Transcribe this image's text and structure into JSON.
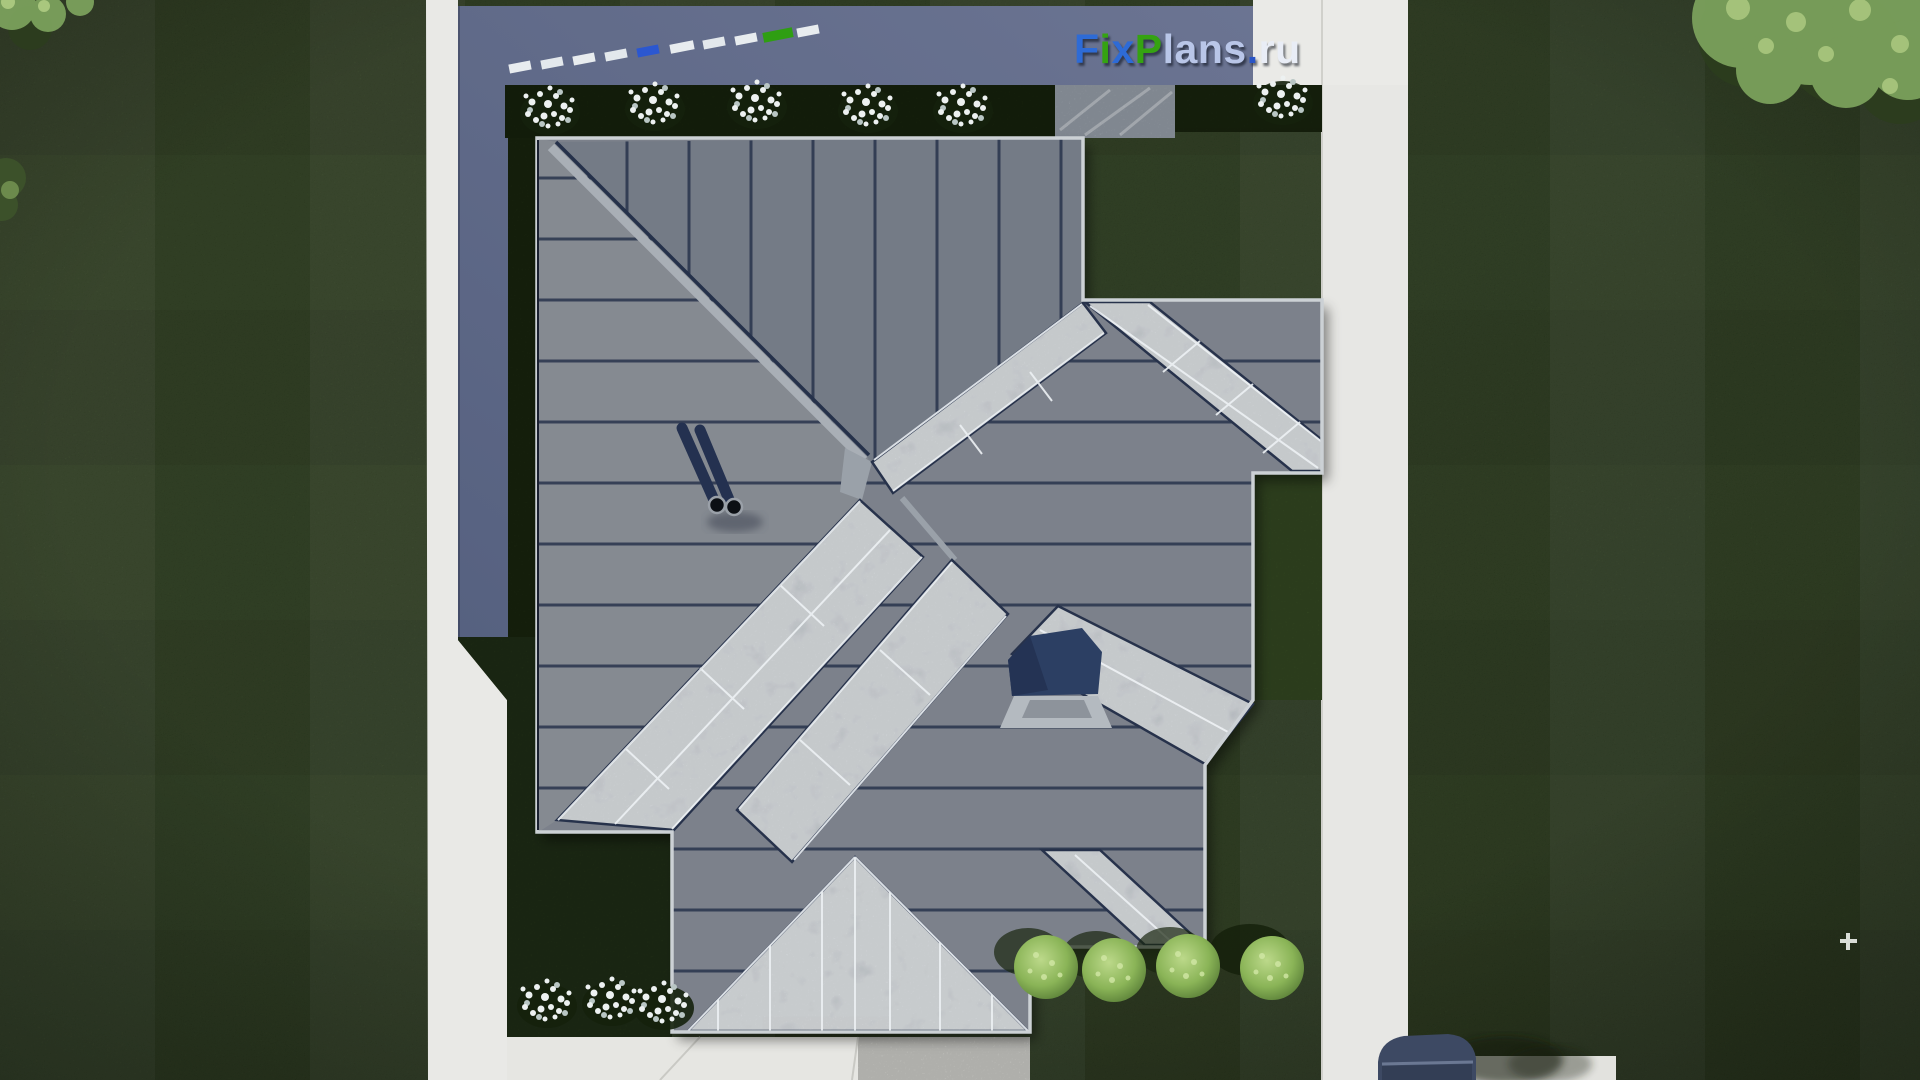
{
  "image": {
    "type": "aerial-top-down-3d-render",
    "subject": "single-family house with gray standing-seam hip roof and long glass skylight bands, surrounded by lawn, concrete paths, paved terrace and landscaping",
    "view": "directly overhead (roof plan render)"
  },
  "watermark": {
    "text": "FixPlans.ru",
    "letters": [
      "F",
      "i",
      "x",
      "P",
      "l",
      "a",
      "n",
      "s",
      ".",
      "r",
      "u"
    ],
    "letter_colors": [
      "blue",
      "green",
      "blue",
      "green",
      "pale-blue",
      "pale-blue",
      "pale-blue",
      "pale-blue",
      "blue",
      "white",
      "white"
    ]
  },
  "palette": {
    "grass": "#2f421f",
    "grass_dark": "#24331a",
    "concrete_path": "#e9e9e6",
    "terrace": "#5d6786",
    "roof_metal": "#7b818b",
    "roof_seam": "#25314a",
    "skylight_glass": "#b9c0c7",
    "mullion_white": "#eef2f5",
    "hedge_bed": "#1b290f",
    "white_flowers": "#eef2f2",
    "green_bush": "#9cc369",
    "roof_hatch": "#2c3f63",
    "car": "#3d4963",
    "logo_blue": "#2e6bd6",
    "logo_green": "#35a312",
    "logo_pale": "#b9c6e8",
    "logo_white": "#e9edf6"
  },
  "scene": {
    "elements": [
      {
        "name": "lawn",
        "desc": "dark green grass with mowing stripe pattern covering the lot"
      },
      {
        "name": "left-path",
        "desc": "vertical light concrete walkway, widens toward bottom"
      },
      {
        "name": "right-path",
        "desc": "vertical light concrete walkway on east side"
      },
      {
        "name": "bottom-driveway",
        "desc": "light concrete apron along bottom of house with stone-textured pad"
      },
      {
        "name": "terrace",
        "desc": "blue-gray paved terrace wrapping top and left of roof"
      },
      {
        "name": "hip-roof",
        "desc": "gray standing-seam metal roof with 45-degree hips and valleys"
      },
      {
        "name": "skylight-bands",
        "desc": "six light glass skylight strips with white mullions along roof slopes"
      },
      {
        "name": "south-gable-skylight",
        "desc": "large triangular glass gable at bottom center"
      },
      {
        "name": "roof-hatch",
        "desc": "dark navy opened roof hatch with light skirt, right of center"
      },
      {
        "name": "chimney-flues",
        "desc": "two round flue pipes with long shadows on west slope"
      },
      {
        "name": "flower-beds",
        "desc": "dark planting beds with nine white flower bushes"
      },
      {
        "name": "green-bushes",
        "desc": "row of four round yellow-green shrubs below southeast eave"
      },
      {
        "name": "trees",
        "desc": "leafy canopies at top-right and top-left corners"
      },
      {
        "name": "car",
        "desc": "dark slate car roof entering at bottom-right on the path"
      },
      {
        "name": "marker-dashes",
        "desc": "diagonal row of small white, blue and green dashes on terrace near top"
      }
    ],
    "counts": {
      "white_flower_bushes": 9,
      "green_bushes": 4,
      "chimney_flues": 2,
      "skylight_bands": 6
    }
  }
}
